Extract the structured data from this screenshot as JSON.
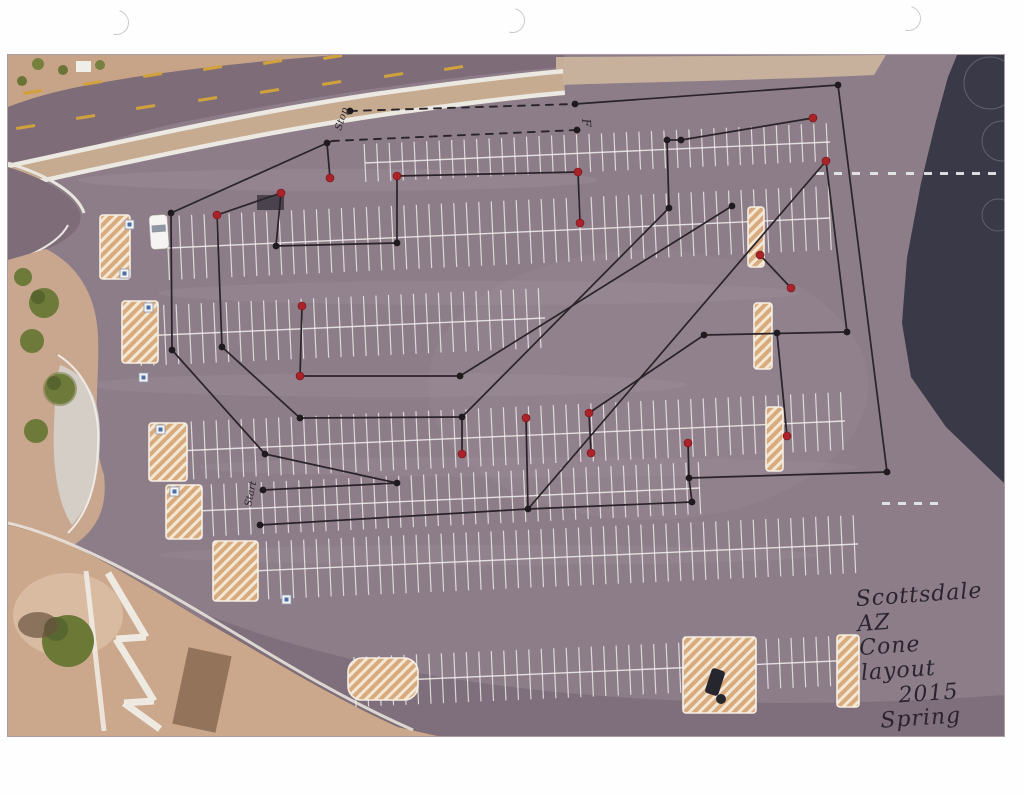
{
  "page": {
    "punch_holes": [
      [
        104,
        10
      ],
      [
        500,
        8
      ],
      [
        896,
        6
      ]
    ],
    "photo": {
      "x": 8,
      "y": 55,
      "w": 996,
      "h": 681
    }
  },
  "annotation": {
    "title_line1": "Scottsdale AZ",
    "title_line2": "Cone layout",
    "title_line3": "2015",
    "title_line4": "Spring"
  },
  "colors": {
    "asphalt": "#8d7d89",
    "road": "#7e6c79",
    "dirt": "#c9a68e",
    "concrete": "#d6d0c9",
    "dark_area": "#393947",
    "hatch_fill": "#d8ab7e",
    "course_line": "#2a2328",
    "cone_black": "#1f1a1e",
    "cone_red": "#aa2328",
    "stall_paint": "#f3f0ee",
    "road_dash_yellow": "#d1a23c"
  },
  "course": {
    "labels": [
      {
        "text": "Stop",
        "x": 333,
        "y": 76,
        "rot": -72,
        "size": 10
      },
      {
        "text": "F",
        "x": 574,
        "y": 64,
        "rot": 85,
        "size": 12
      },
      {
        "text": "Start",
        "x": 243,
        "y": 452,
        "rot": -78,
        "size": 10
      }
    ],
    "black_cones": [
      [
        319,
        88
      ],
      [
        163,
        158
      ],
      [
        268,
        191
      ],
      [
        389,
        188
      ],
      [
        659,
        85
      ],
      [
        673,
        85
      ],
      [
        830,
        30
      ],
      [
        724,
        151
      ],
      [
        661,
        153
      ],
      [
        164,
        295
      ],
      [
        214,
        292
      ],
      [
        292,
        363
      ],
      [
        452,
        321
      ],
      [
        454,
        362
      ],
      [
        257,
        399
      ],
      [
        255,
        435
      ],
      [
        252,
        470
      ],
      [
        389,
        428
      ],
      [
        520,
        454
      ],
      [
        684,
        447
      ],
      [
        681,
        423
      ],
      [
        696,
        280
      ],
      [
        769,
        278
      ],
      [
        839,
        277
      ],
      [
        879,
        417
      ],
      [
        342,
        56
      ],
      [
        567,
        49
      ],
      [
        569,
        75
      ]
    ],
    "red_cones": [
      [
        322,
        123
      ],
      [
        273,
        138
      ],
      [
        209,
        160
      ],
      [
        389,
        121
      ],
      [
        570,
        117
      ],
      [
        572,
        168
      ],
      [
        805,
        63
      ],
      [
        818,
        106
      ],
      [
        752,
        200
      ],
      [
        783,
        233
      ],
      [
        294,
        251
      ],
      [
        292,
        321
      ],
      [
        454,
        399
      ],
      [
        518,
        363
      ],
      [
        581,
        358
      ],
      [
        583,
        398
      ],
      [
        680,
        388
      ],
      [
        779,
        381
      ]
    ],
    "segments": [
      [
        319,
        88,
        163,
        158
      ],
      [
        163,
        158,
        164,
        295
      ],
      [
        164,
        295,
        257,
        399
      ],
      [
        209,
        160,
        214,
        292
      ],
      [
        214,
        292,
        292,
        363
      ],
      [
        273,
        138,
        209,
        160
      ],
      [
        268,
        191,
        273,
        138
      ],
      [
        268,
        191,
        389,
        188
      ],
      [
        389,
        188,
        389,
        121
      ],
      [
        389,
        121,
        570,
        117
      ],
      [
        319,
        88,
        322,
        123
      ],
      [
        567,
        49,
        830,
        30
      ],
      [
        830,
        30,
        879,
        417
      ],
      [
        659,
        85,
        661,
        153
      ],
      [
        659,
        85,
        673,
        85
      ],
      [
        673,
        85,
        805,
        63
      ],
      [
        818,
        106,
        839,
        277
      ],
      [
        839,
        277,
        696,
        280
      ],
      [
        696,
        280,
        581,
        358
      ],
      [
        581,
        358,
        583,
        398
      ],
      [
        518,
        363,
        520,
        454
      ],
      [
        454,
        362,
        454,
        399
      ],
      [
        292,
        321,
        294,
        251
      ],
      [
        292,
        321,
        452,
        321
      ],
      [
        292,
        363,
        454,
        362
      ],
      [
        661,
        153,
        454,
        362
      ],
      [
        724,
        151,
        452,
        321
      ],
      [
        818,
        106,
        520,
        454
      ],
      [
        389,
        428,
        257,
        399
      ],
      [
        389,
        428,
        255,
        435
      ],
      [
        252,
        470,
        520,
        454
      ],
      [
        520,
        454,
        684,
        447
      ],
      [
        684,
        447,
        681,
        423
      ],
      [
        680,
        388,
        681,
        423
      ],
      [
        681,
        423,
        879,
        417
      ],
      [
        752,
        200,
        783,
        233
      ],
      [
        570,
        117,
        572,
        168
      ],
      [
        769,
        278,
        779,
        381
      ],
      [
        319,
        88,
        324,
        86
      ]
    ],
    "dashed_segments": [
      [
        342,
        56,
        567,
        49
      ],
      [
        324,
        86,
        569,
        75
      ]
    ]
  },
  "parking": {
    "tick_step": 12.5,
    "rows": [
      {
        "x1": 357,
        "y1": 108,
        "x2": 822,
        "y2": 87,
        "half": 19
      },
      {
        "x1": 160,
        "y1": 193,
        "x2": 822,
        "y2": 163,
        "half": 32
      },
      {
        "x1": 132,
        "y1": 281,
        "x2": 537,
        "y2": 263,
        "half": 30
      },
      {
        "x1": 147,
        "y1": 397,
        "x2": 837,
        "y2": 366,
        "half": 29
      },
      {
        "x1": 167,
        "y1": 457,
        "x2": 692,
        "y2": 433,
        "half": 26
      },
      {
        "x1": 222,
        "y1": 517,
        "x2": 850,
        "y2": 489,
        "half": 29
      },
      {
        "x1": 347,
        "y1": 627,
        "x2": 850,
        "y2": 605,
        "half": 25
      }
    ],
    "islands": [
      {
        "x": 92,
        "y": 160,
        "w": 30,
        "h": 64
      },
      {
        "x": 114,
        "y": 246,
        "w": 36,
        "h": 62
      },
      {
        "x": 141,
        "y": 368,
        "w": 38,
        "h": 58
      },
      {
        "x": 158,
        "y": 430,
        "w": 36,
        "h": 54
      },
      {
        "x": 205,
        "y": 486,
        "w": 45,
        "h": 60
      },
      {
        "x": 340,
        "y": 603,
        "w": 70,
        "h": 42,
        "rx": 14
      },
      {
        "x": 740,
        "y": 152,
        "w": 16,
        "h": 60
      },
      {
        "x": 746,
        "y": 248,
        "w": 18,
        "h": 66
      },
      {
        "x": 758,
        "y": 352,
        "w": 17,
        "h": 64
      },
      {
        "x": 675,
        "y": 582,
        "w": 73,
        "h": 76
      },
      {
        "x": 829,
        "y": 580,
        "w": 22,
        "h": 72
      }
    ],
    "handicap_squares": [
      [
        117,
        165
      ],
      [
        112,
        214
      ],
      [
        136,
        248
      ],
      [
        131,
        318
      ],
      [
        148,
        370
      ],
      [
        162,
        432
      ],
      [
        274,
        540
      ]
    ],
    "lane_dashes": [
      {
        "y": 117,
        "xs": [
          808,
          826,
          844,
          862,
          880,
          898,
          916,
          932,
          948,
          964,
          980
        ]
      },
      {
        "y": 447,
        "xs": [
          874,
          890,
          906,
          922
        ]
      }
    ],
    "road_dashes_upper": [
      [
        15,
        37
      ],
      [
        75,
        28
      ],
      [
        135,
        20
      ],
      [
        195,
        13
      ],
      [
        255,
        7
      ],
      [
        315,
        2
      ]
    ],
    "road_dashes_lower": [
      [
        8,
        72
      ],
      [
        68,
        62
      ],
      [
        128,
        52
      ],
      [
        190,
        44
      ],
      [
        252,
        36
      ],
      [
        314,
        28
      ],
      [
        376,
        20
      ],
      [
        436,
        13
      ]
    ]
  }
}
